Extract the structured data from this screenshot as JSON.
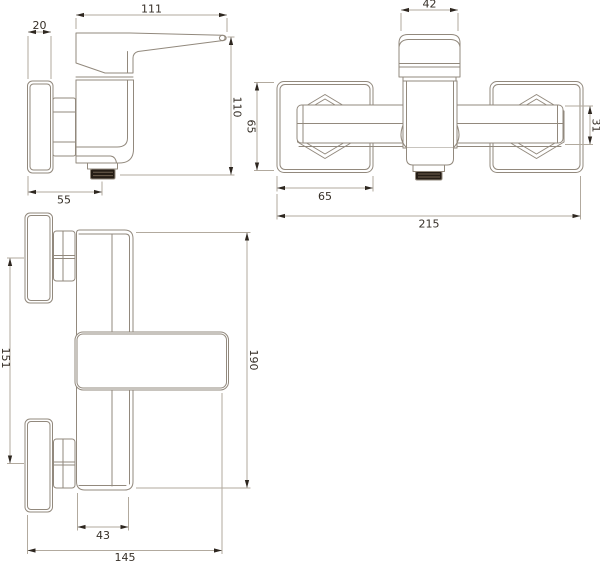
{
  "drawing": {
    "kind": "technical-drawing",
    "colors": {
      "object_line": "#92897d",
      "dimension_line": "#b2aa9e",
      "text_and_arrows": "#362f27",
      "outlet_fill": "#251d15",
      "background": "#ffffff"
    },
    "views": {
      "side": {
        "dims": {
          "plate_thickness": "20",
          "lever_length": "111",
          "overall_height": "110",
          "outlet_offset": "55"
        }
      },
      "top": {
        "dims": {
          "handle_width": "42",
          "escutcheon_height": "65",
          "bar_height": "31",
          "escutcheon_width": "65",
          "overall_width": "215"
        }
      },
      "front": {
        "dims": {
          "centers_distance": "151",
          "overall_height": "190",
          "body_width": "43",
          "overall_depth": "145"
        }
      }
    }
  }
}
